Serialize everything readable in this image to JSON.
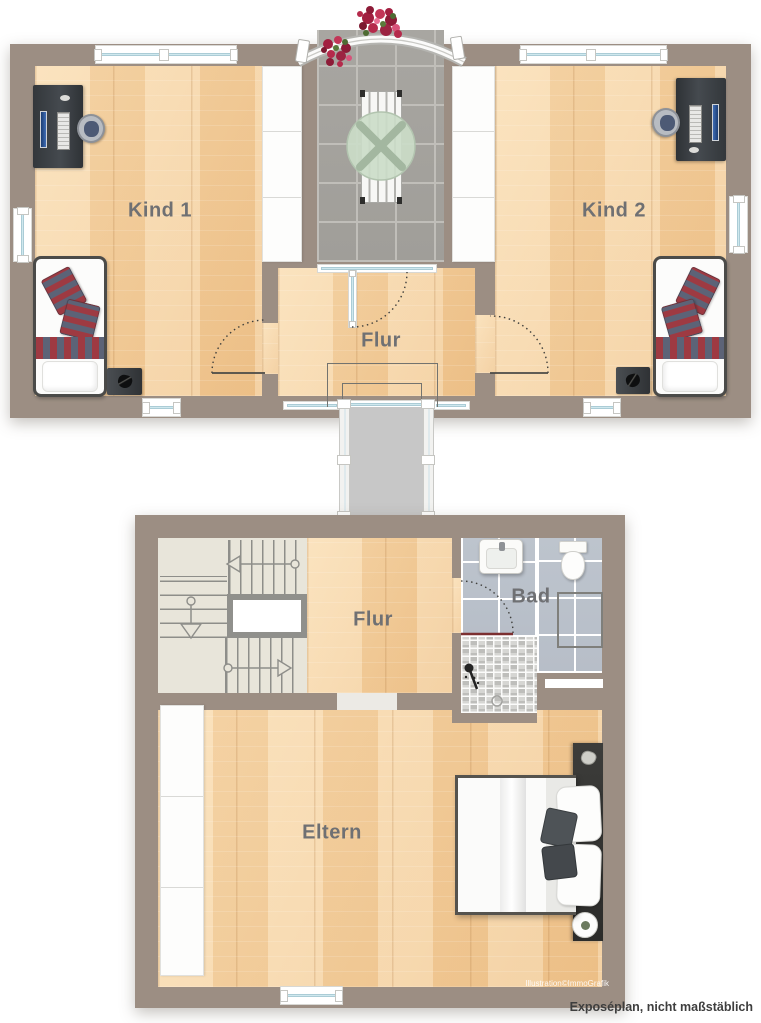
{
  "plan": {
    "footer": {
      "note": "Exposéplan, nicht maßstäblich",
      "credit": "Illustration©ImmoGrafik"
    },
    "rooms": {
      "kind1": {
        "label": "Kind 1"
      },
      "kind2": {
        "label": "Kind 2"
      },
      "flur_top": {
        "label": "Flur"
      },
      "flur_bottom": {
        "label": "Flur"
      },
      "bad": {
        "label": "Bad"
      },
      "eltern": {
        "label": "Eltern"
      }
    },
    "colors": {
      "wall": "#9c8e83",
      "wood_floor": "#f2c997",
      "balcony_tile": "#a8a6a1",
      "bath_tile": "#bcc3cc",
      "stair_floor": "#e8e5da",
      "corridor_floor": "#c7c7c7",
      "label_text": "#6f7073",
      "stripe_red": "#9e3a42",
      "stripe_blue": "#5c6377",
      "door_swing": "#3f3f3c",
      "shower_line": "#7c2f30"
    }
  }
}
